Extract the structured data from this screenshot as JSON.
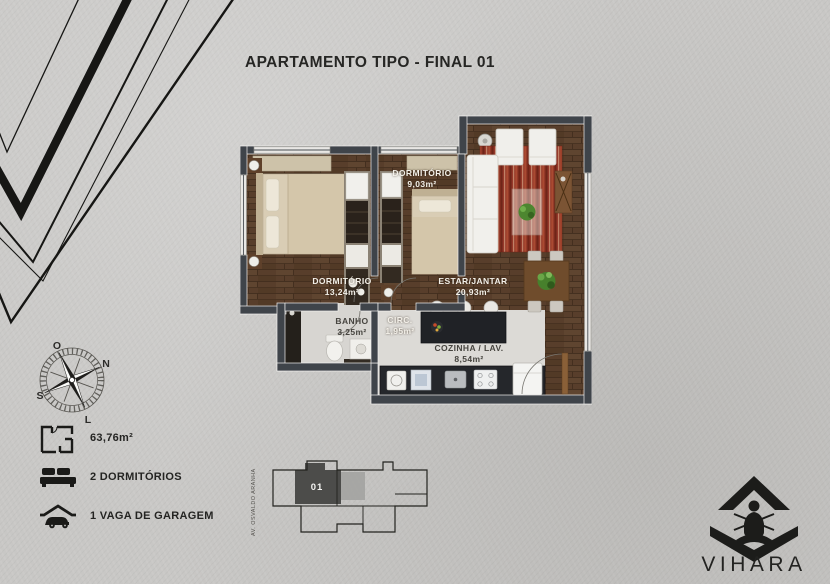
{
  "title": "APARTAMENTO TIPO - FINAL 01",
  "plan": {
    "rooms": [
      {
        "name": "DORMITÓRIO",
        "area": "9,03m²"
      },
      {
        "name": "DORMITÓRIO",
        "area": "13,24m²"
      },
      {
        "name": "ESTAR/JANTAR",
        "area": "20,93m²"
      },
      {
        "name": "BANHO",
        "area": "3,25m²"
      },
      {
        "name": "CIRC.",
        "area": "1,95m²"
      },
      {
        "name": "COZINHA / LAV.",
        "area": "8,54m²"
      }
    ]
  },
  "compass": {
    "o": "O",
    "n": "N",
    "s": "S",
    "l": "L"
  },
  "info": {
    "items": [
      {
        "icon": "floorplan-icon",
        "label": "63,76m²"
      },
      {
        "icon": "bed-icon",
        "label": "2 DORMITÓRIOS"
      },
      {
        "icon": "garage-icon",
        "label": "1 VAGA DE GARAGEM"
      }
    ]
  },
  "keyplan": {
    "unit": "01",
    "street": "AV. OSVALDO ARANHA"
  },
  "logo": {
    "name": "VIHARA"
  },
  "colors": {
    "background": "#c8c7c5",
    "wall": "#3f444a",
    "wood_floor": "#583e2b",
    "light_floor": "#dcdad6",
    "rug_red": "#96392a",
    "ink": "#1c1c1a"
  }
}
